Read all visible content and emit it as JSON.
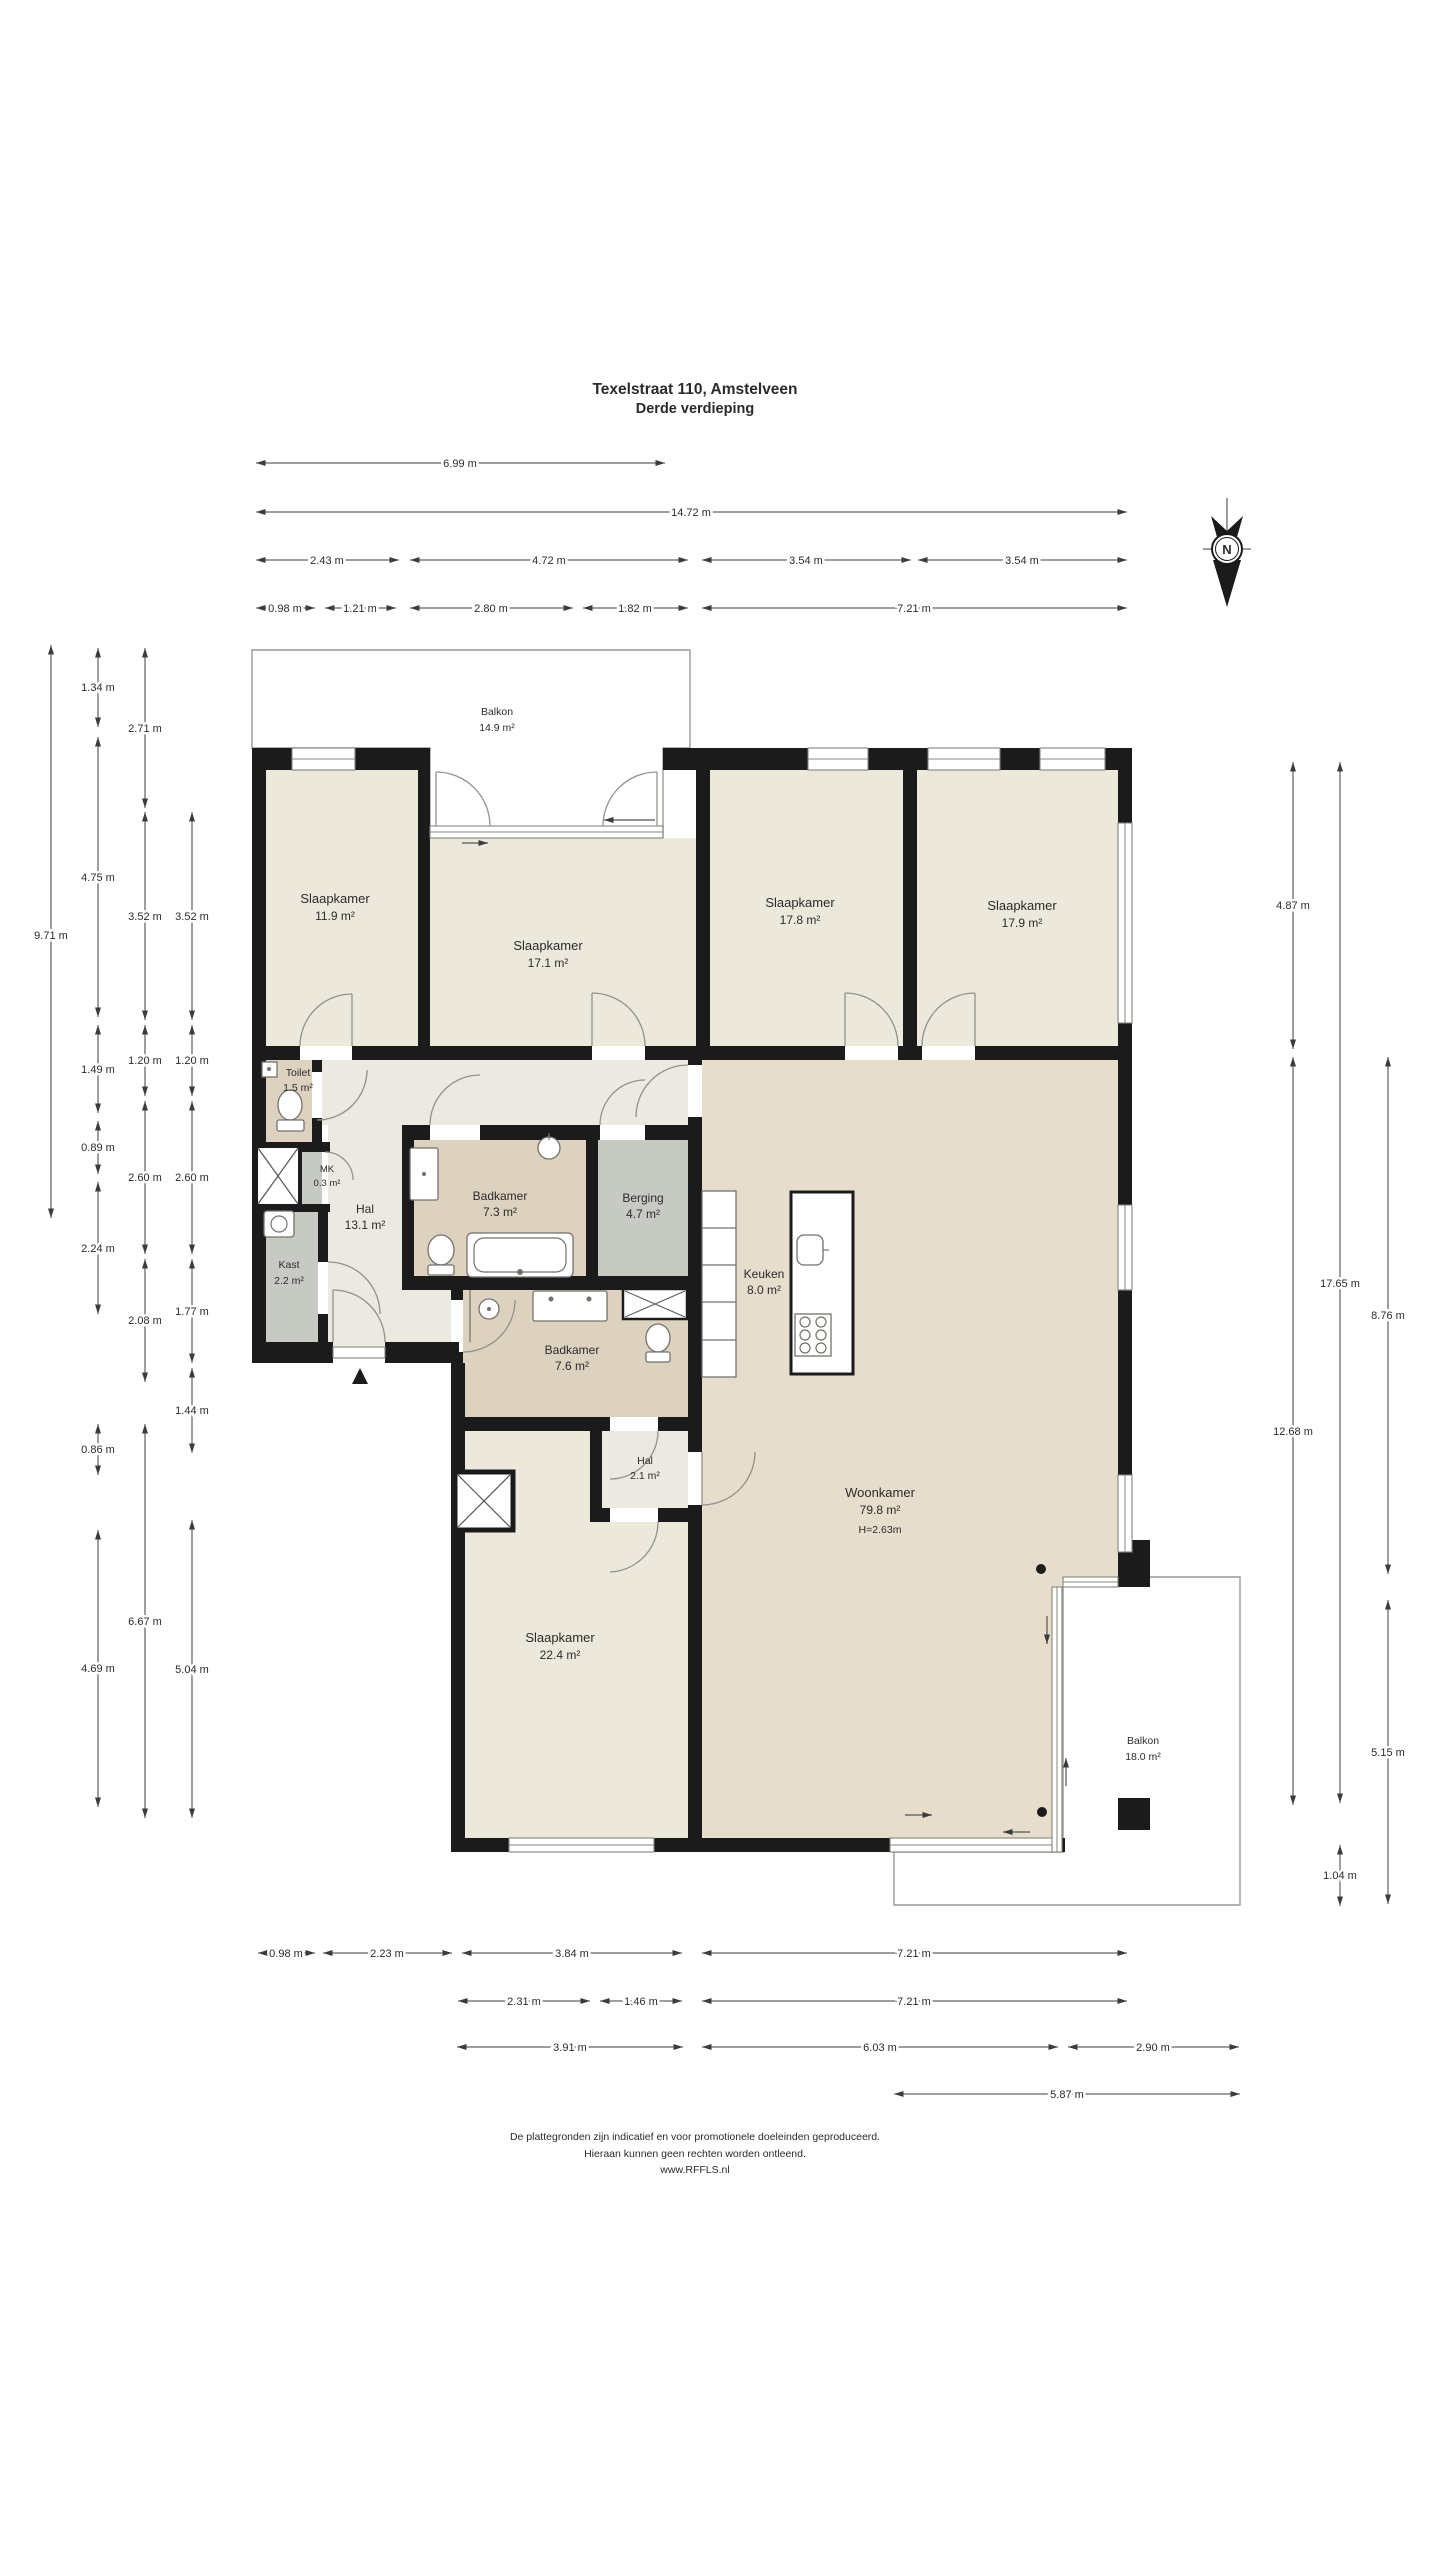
{
  "title": {
    "line1": "Texelstraat 110, Amstelveen",
    "line2": "Derde verdieping"
  },
  "compass": {
    "north_label": "N"
  },
  "rooms": [
    {
      "name": "Balkon",
      "area": "14.9 m²"
    },
    {
      "name": "Slaapkamer",
      "area": "11.9 m²"
    },
    {
      "name": "Slaapkamer",
      "area": "17.1 m²"
    },
    {
      "name": "Slaapkamer",
      "area": "17.8 m²"
    },
    {
      "name": "Slaapkamer",
      "area": "17.9 m²"
    },
    {
      "name": "Toilet",
      "area": "1.5 m²"
    },
    {
      "name": "MK",
      "area": "0.3 m²"
    },
    {
      "name": "Hal",
      "area": "13.1 m²"
    },
    {
      "name": "Kast",
      "area": "2.2 m²"
    },
    {
      "name": "Badkamer",
      "area": "7.3 m²"
    },
    {
      "name": "Berging",
      "area": "4.7 m²"
    },
    {
      "name": "Keuken",
      "area": "8.0 m²"
    },
    {
      "name": "Badkamer",
      "area": "7.6 m²"
    },
    {
      "name": "Hal",
      "area": "2.1 m²"
    },
    {
      "name": "Slaapkamer",
      "area": "22.4 m²"
    },
    {
      "name": "Woonkamer",
      "area": "79.8 m²",
      "ceiling": "H=2.63m"
    },
    {
      "name": "Balkon",
      "area": "18.0 m²"
    }
  ],
  "dimensions": {
    "top": [
      "6.99 m",
      "14.72 m",
      "2.43 m",
      "4.72 m",
      "3.54 m",
      "3.54 m",
      "0.98 m",
      "1.21 m",
      "2.80 m",
      "1.82 m",
      "7.21 m"
    ],
    "left": [
      "9.71 m",
      "1.34 m",
      "4.75 m",
      "1.49 m",
      "0.89 m",
      "2.24 m",
      "0.86 m",
      "4.69 m",
      "2.71 m",
      "3.52 m",
      "1.20 m",
      "2.60 m",
      "2.08 m",
      "6.67 m",
      "3.52 m",
      "1.20 m",
      "2.60 m",
      "1.77 m",
      "1.44 m",
      "5.04 m"
    ],
    "right": [
      "4.87 m",
      "12.68 m",
      "17.65 m",
      "1.04 m",
      "8.76 m",
      "5.15 m"
    ],
    "bottom": [
      "0.98 m",
      "2.23 m",
      "3.84 m",
      "7.21 m",
      "2.31 m",
      "1.46 m",
      "7.21 m",
      "3.91 m",
      "6.03 m",
      "2.90 m",
      "5.87 m"
    ]
  },
  "footer": {
    "line1": "De plattegronden zijn indicatief en voor promotionele doeleinden geproduceerd.",
    "line2": "Hieraan kunnen geen rechten worden ontleend.",
    "line3": "www.RFFLS.nl"
  },
  "colors": {
    "wall": "#1b1b1b",
    "bedroom_fill": "#ece8dc",
    "living_fill": "#e7ddcc",
    "bath_fill": "#ddd1c0",
    "hall_fill": "#ebe9e1",
    "storage_fill": "#c7c9c3",
    "deck_fill": "#d8d8d2",
    "deck_stripe": "#b2b2ab"
  }
}
